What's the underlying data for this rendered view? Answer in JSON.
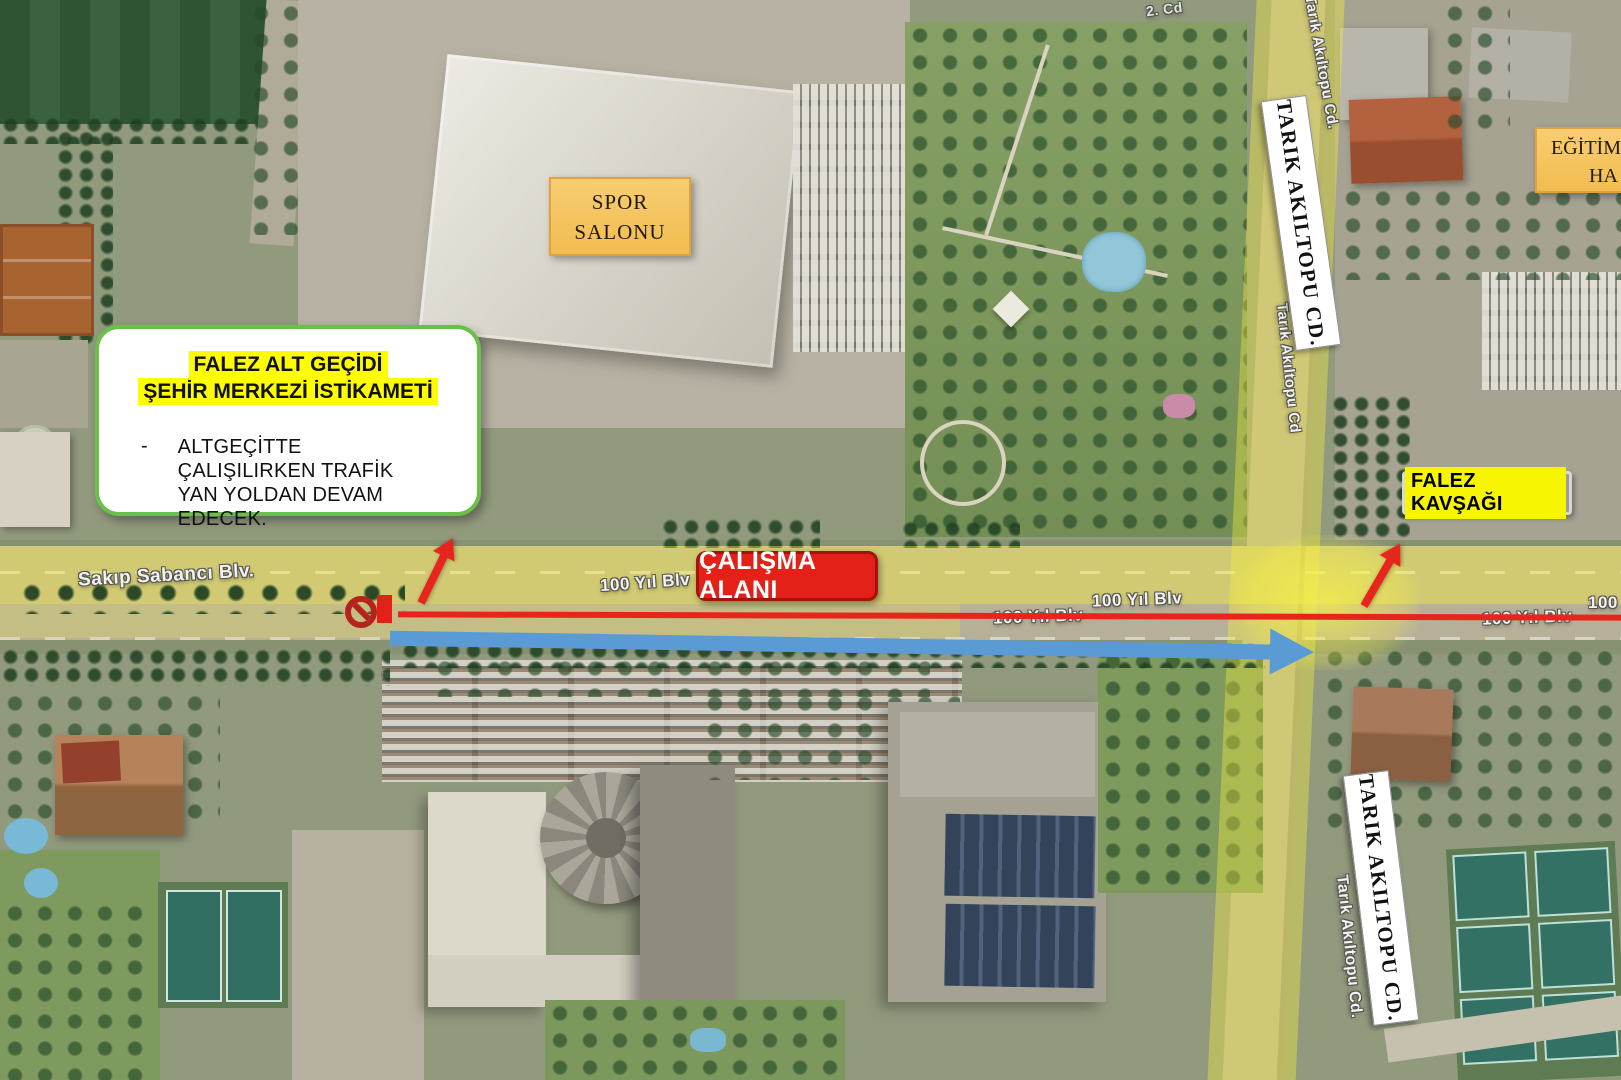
{
  "callout": {
    "title_line1": "FALEZ ALT GEÇİDİ",
    "title_line2": "ŞEHİR MERKEZİ İSTİKAMETİ",
    "bullet_marker": "-",
    "body": "ALTGEÇİTTE ÇALIŞILIRKEN TRAFİK YAN YOLDAN DEVAM EDECEK."
  },
  "labels": {
    "spor_line1": "SPOR",
    "spor_line2": "SALONU",
    "egitim_line1": "EĞİTİM",
    "egitim_line2": "HA",
    "tarik_top": "TARIK AKILTOPU CD.",
    "tarik_bottom": "TARIK AKILTOPU CD.",
    "falez_kavsagi": "FALEZ KAVŞAĞI",
    "calisma_alani": "ÇALIŞMA ALANI"
  },
  "street_labels": {
    "sakip_sabanci": "Sakıp Sabancı Blv.",
    "yuzyil_1": "100 Yıl Blv",
    "yuzyil_2": "100 Yıl Blv",
    "yuzyil_3": "100 Yıl Blv",
    "yuzyil_4": "100 Yıl Blv",
    "yuzyil_short": "100",
    "cadde_2": "2. Cd",
    "tarik_map_top": "Tarık Akıltopu Cd.",
    "tarik_map_mid": "Tarık Akıltopu Cd",
    "tarik_map_bottom": "Tarık Akıltopu Cd."
  },
  "icons": {
    "no_entry": "no-entry-icon",
    "route_blue": "blue-route-arrow",
    "detour_red": "red-detour-arrow"
  },
  "colors": {
    "highlight_yellow": "#FDFD00",
    "callout_border_green": "#6CBF4A",
    "label_orange": "#F6C766",
    "work_zone_red": "#E32119",
    "route_blue": "#5B9BD5",
    "kavsagi_gray": "#9C9C9C",
    "road_highlight": "rgba(246,238,64,0.4)"
  }
}
